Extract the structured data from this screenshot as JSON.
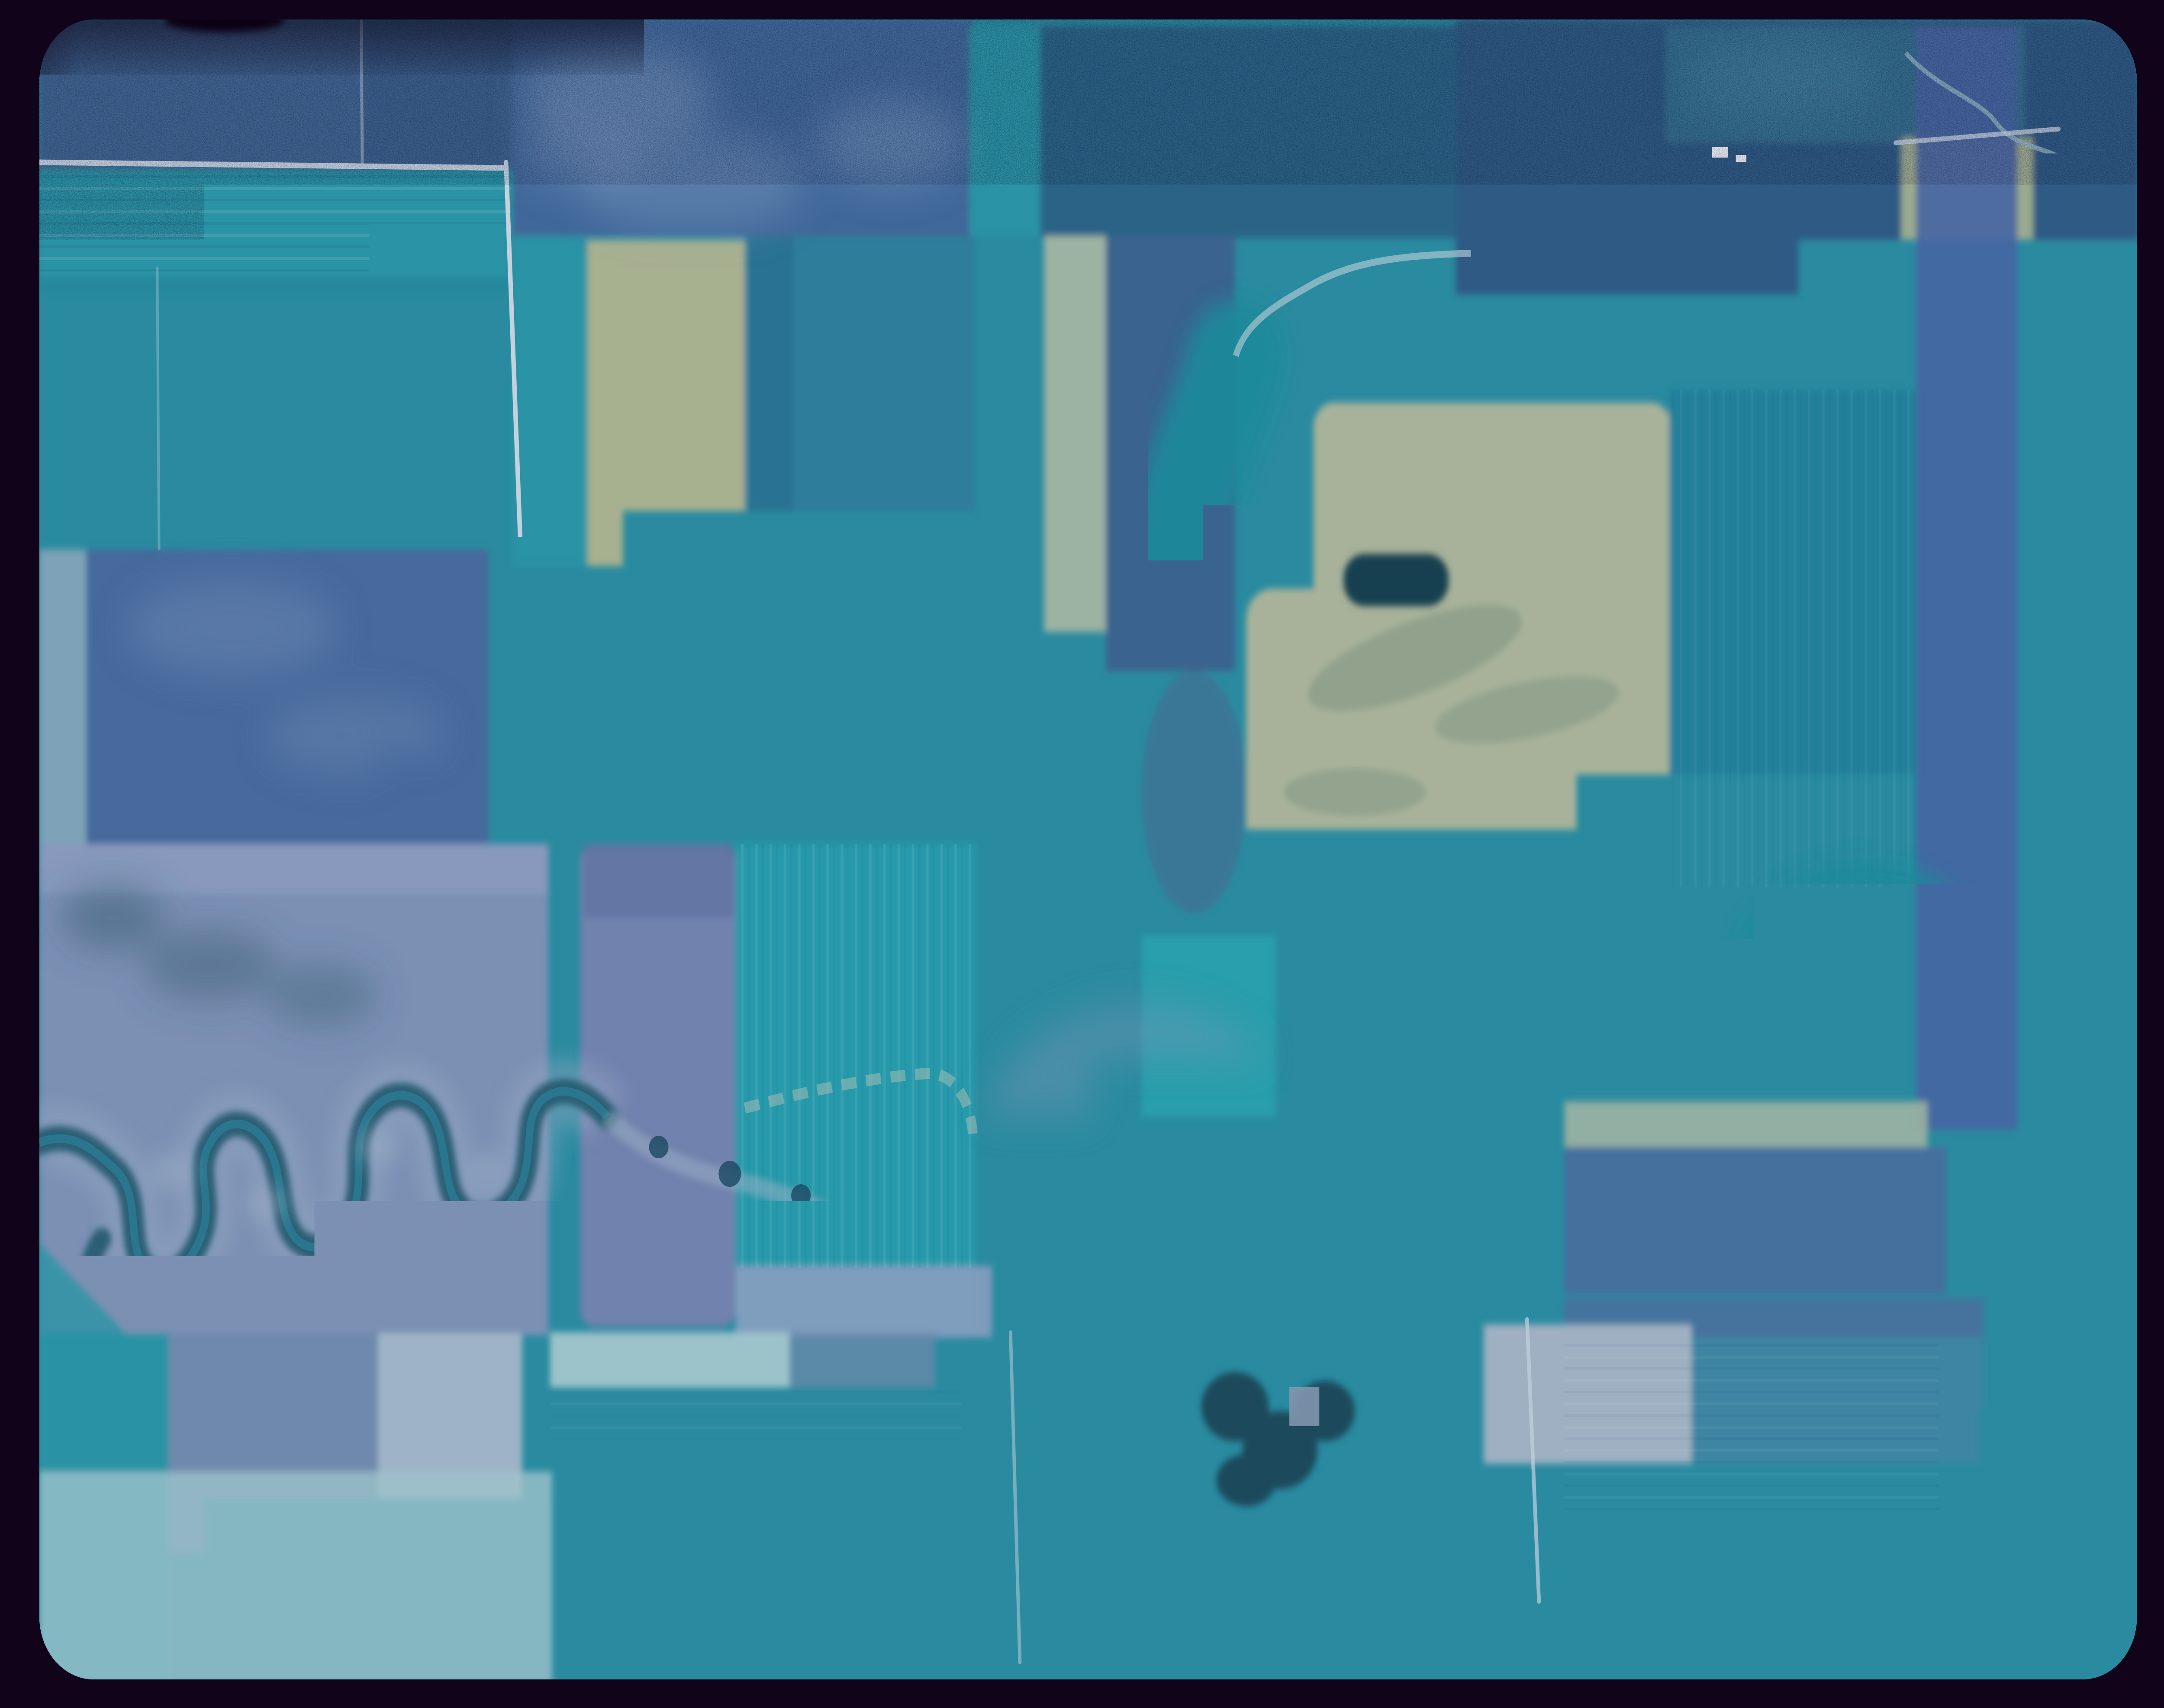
{
  "image": {
    "kind": "film-slide aerial photograph",
    "description": "Cyan-tinted 35mm slide of an aerial photograph of sectioned farmland: teal and steel-blue field mosaic, two meandering tree-lined creeks, light section-line roads, farmsteads with white buildings and shelterbelts, a slough with a sand bar, dark film border with rounded photo corners, heavy dust specks, and dark shadows along the right edge and bottom."
  },
  "palette": {
    "border": "#11031a",
    "shadow": "#0c0213",
    "photoBase": "#2a8ba0",
    "tealRow": "#2a93a5",
    "tealDeep": "#1d8a9b",
    "tealBright": "#27a0ad",
    "tealDark": "#24809a",
    "tealStriate": "#289aab",
    "tealBR": "#3d85a2",
    "blueSteel1": "#3f6592",
    "blueSteel2": "#3a608d",
    "blueMottled": "#40689a",
    "blueMuted": "#2b6386",
    "blueTopRight": "#2e5a84",
    "blueBand": "#3a648f",
    "blueMutedBR": "#44709e",
    "blueWaveBand": "#4a6f9d",
    "slateBig": "#46699c",
    "lavender": "#7182ae",
    "lavenderDark": "#5b6e9d",
    "lavPale": "#8e9dc0",
    "floodplain": "#7b90b4",
    "paleSlate": "#9fb0c2",
    "paleLeft": "#7ea2b8",
    "mintPale": "#9cc2ca",
    "mintStreak": "#b9d4d6",
    "sage": "#a8b29a",
    "sageStrip": "#a7b08f",
    "sageMint": "#9cb2a2",
    "khakiTR": "#9aaa90",
    "oliveShadow": "#6e8877",
    "marshSlate": "#47688f",
    "blueLav": "#4765a2",
    "lakeBlue": "#6c80ad",
    "lakeRim": "#8396bd",
    "sand": "#c9d2cf",
    "roadLight": "#c3d2de",
    "roadBright": "#e2ecf2",
    "treeDark": "#17414f",
    "treeDark2": "#1c4a5c",
    "treeCore": "#143b4d",
    "riverTree": "#1f4c66",
    "waterLine": "#2a7c95",
    "streamLight": "#a8c6cf",
    "scarLight": "#9db0c6",
    "mottleLight": "#7d9cc0",
    "buildingWhite": "#e9f1f5",
    "dustSpeck": "#1e0d20",
    "darkDapple": "#33586e"
  }
}
